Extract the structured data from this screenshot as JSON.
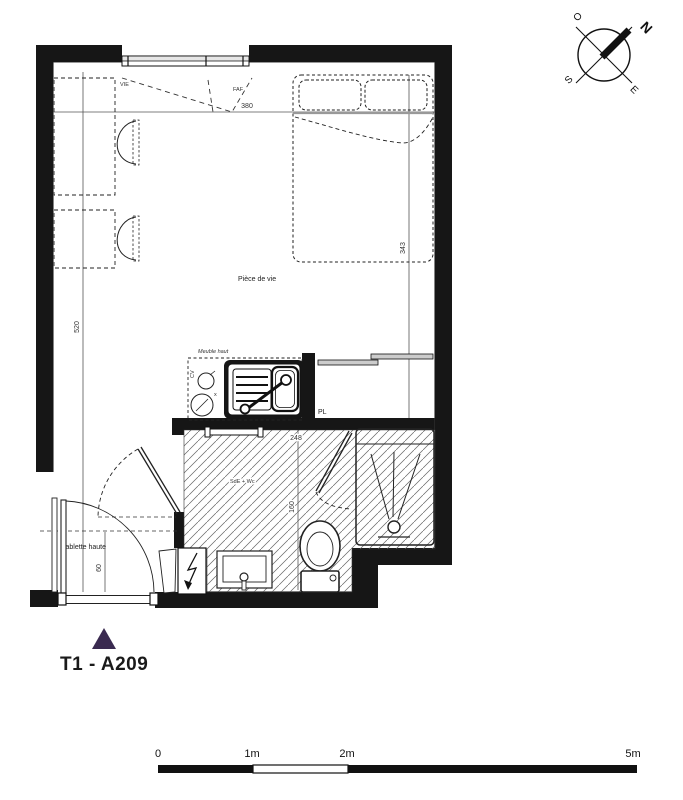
{
  "labels": {
    "unit": "T1 - A209",
    "living": "Pièce de vie",
    "bath": "SdE + Wc",
    "closet": "PL",
    "cabinet": "Meuble haut",
    "shelf": "Tablette haute",
    "vie": "VIE",
    "faf": "FAF",
    "cv": "CV",
    "hob_mark": "x"
  },
  "dimensions": {
    "room_width": "380",
    "room_height": "520",
    "bed_wall": "343",
    "bath_width": "248",
    "bath_height": "160",
    "shelf_depth": "60"
  },
  "compass": {
    "n": "N",
    "e": "E",
    "s": "S",
    "o": "O"
  },
  "scale_bar": {
    "t0": "0",
    "t1": "1m",
    "t2": "2m",
    "t5": "5m"
  },
  "colors": {
    "accent": "#3a2a50",
    "ink": "#1a1a1a"
  }
}
